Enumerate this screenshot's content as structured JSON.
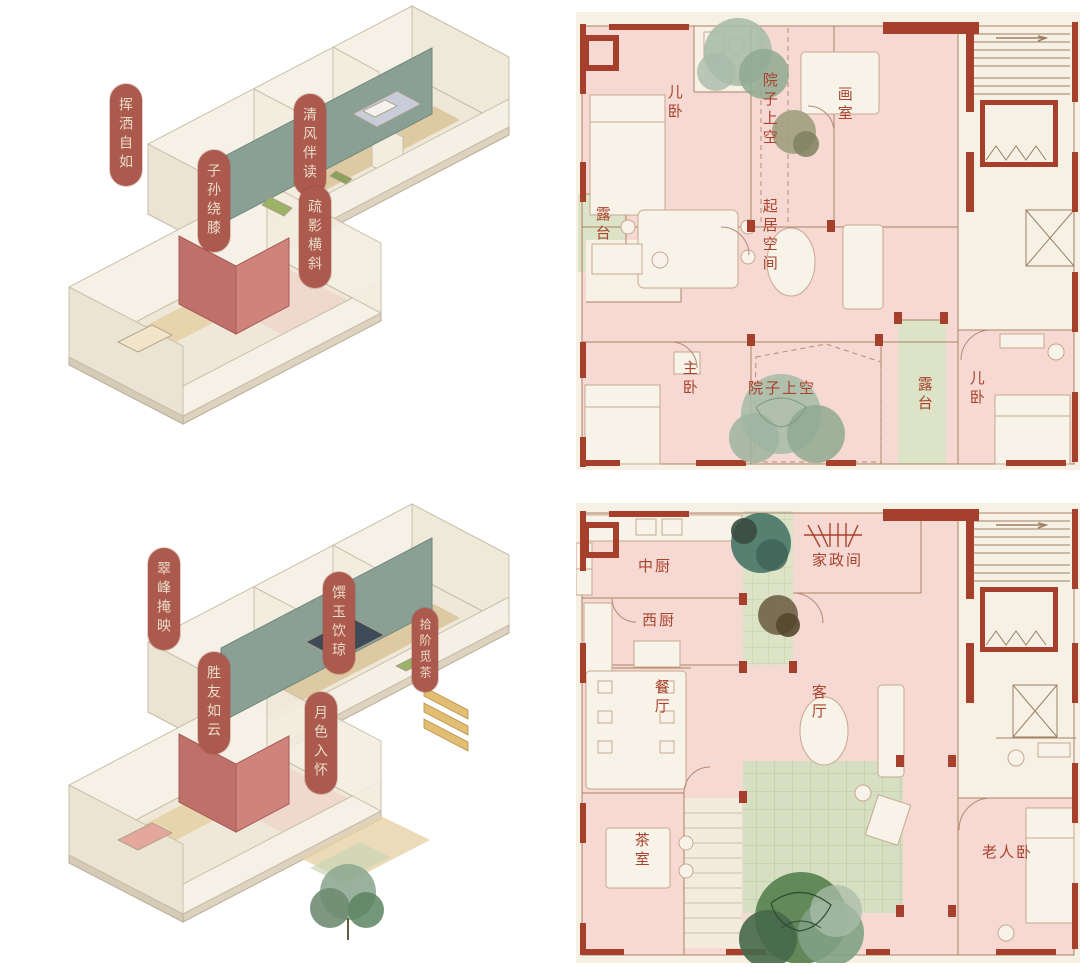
{
  "palette": {
    "wall_red": "#A6402D",
    "room_pink": "#F5D9D2",
    "plan_paper": "#F7F1E5",
    "terrace_green": "#DCE3C7",
    "tatami_green": "#D6DFC2",
    "pill_red": "#AC594E",
    "pill_text": "#EADCC7",
    "room_label_red": "#A8432E",
    "sage_wall": "#8BA095",
    "accent_red_wall": "#C0706A",
    "wood_floor": "#DCC79C",
    "tree_sage": "#A9BCA9",
    "tree_dark": "#4E7A6B",
    "tree_deep_green": "#5C8452"
  },
  "axon_top": {
    "labels": [
      {
        "text": "挥洒自如"
      },
      {
        "text": "清风伴读"
      },
      {
        "text": "子孙绕膝"
      },
      {
        "text": "疏影横斜"
      }
    ]
  },
  "axon_bottom": {
    "labels": [
      {
        "text": "翠峰掩映"
      },
      {
        "text": "馔玉饮琼"
      },
      {
        "text": "胜友如云"
      },
      {
        "text": "月色入怀"
      },
      {
        "text": "拾阶觅茶"
      }
    ]
  },
  "plan_top": {
    "rooms": {
      "er_wo_left": "儿卧",
      "yuanzi_shangkong_top": "院子上空",
      "hua_shi": "画室",
      "lutai_left": "露台",
      "qiju_kongjian": "起居空间",
      "zhu_wo": "主卧",
      "yuanzi_shangkong_bottom": "院子上空",
      "lutai_right": "露台",
      "er_wo_right": "儿卧"
    }
  },
  "plan_bottom": {
    "rooms": {
      "zhong_chu": "中厨",
      "jiazheng_jian": "家政间",
      "xi_chu": "西厨",
      "can_ting": "餐厅",
      "ke_ting": "客厅",
      "cha_shi": "茶室",
      "laoren_wo": "老人卧"
    }
  }
}
